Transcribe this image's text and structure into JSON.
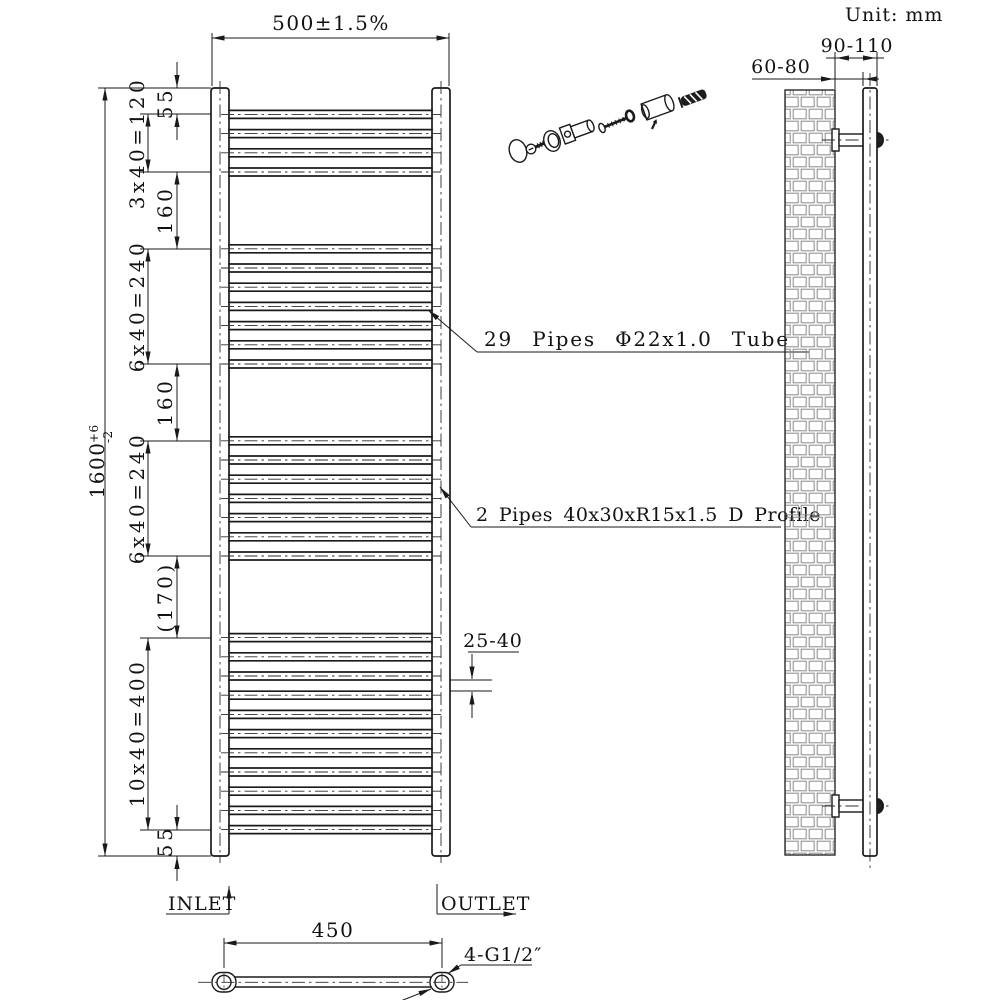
{
  "unit_label": "Unit: mm",
  "front_view": {
    "width_dim": "500±1.5%",
    "height_dim_value": "1600",
    "height_dim_tol_plus": "+6",
    "height_dim_tol_minus": "-2",
    "left_chain": {
      "top_offset": "55",
      "group1": "3x40=120",
      "gap1": "160",
      "group2": "6x40=240",
      "gap2": "160",
      "group3": "6x40=240",
      "gap3": "(170)",
      "group4": "10x40=400",
      "bottom_offset": "55"
    },
    "pipe_gap_dim": "25-40",
    "pipe_annotation": "29 Pipes Φ22x1.0 Tube",
    "profile_annotation": "2 Pipes 40x30xR15x1.5 D Profile",
    "pipe_spacing_mm": 40,
    "pipe_groups": [
      {
        "count": 4,
        "start_mm": 55
      },
      {
        "count": 7,
        "start_mm": 335
      },
      {
        "count": 7,
        "start_mm": 735
      },
      {
        "count": 11,
        "start_mm": 1145
      }
    ]
  },
  "side_view": {
    "wall_to_rail_dim": "60-80",
    "wall_to_outer_dim": "90-110"
  },
  "bottom_view": {
    "inlet_label": "INLET",
    "outlet_label": "OUTLET",
    "hole_distance_dim": "450",
    "thread_annotation": "4-G1/2″"
  }
}
